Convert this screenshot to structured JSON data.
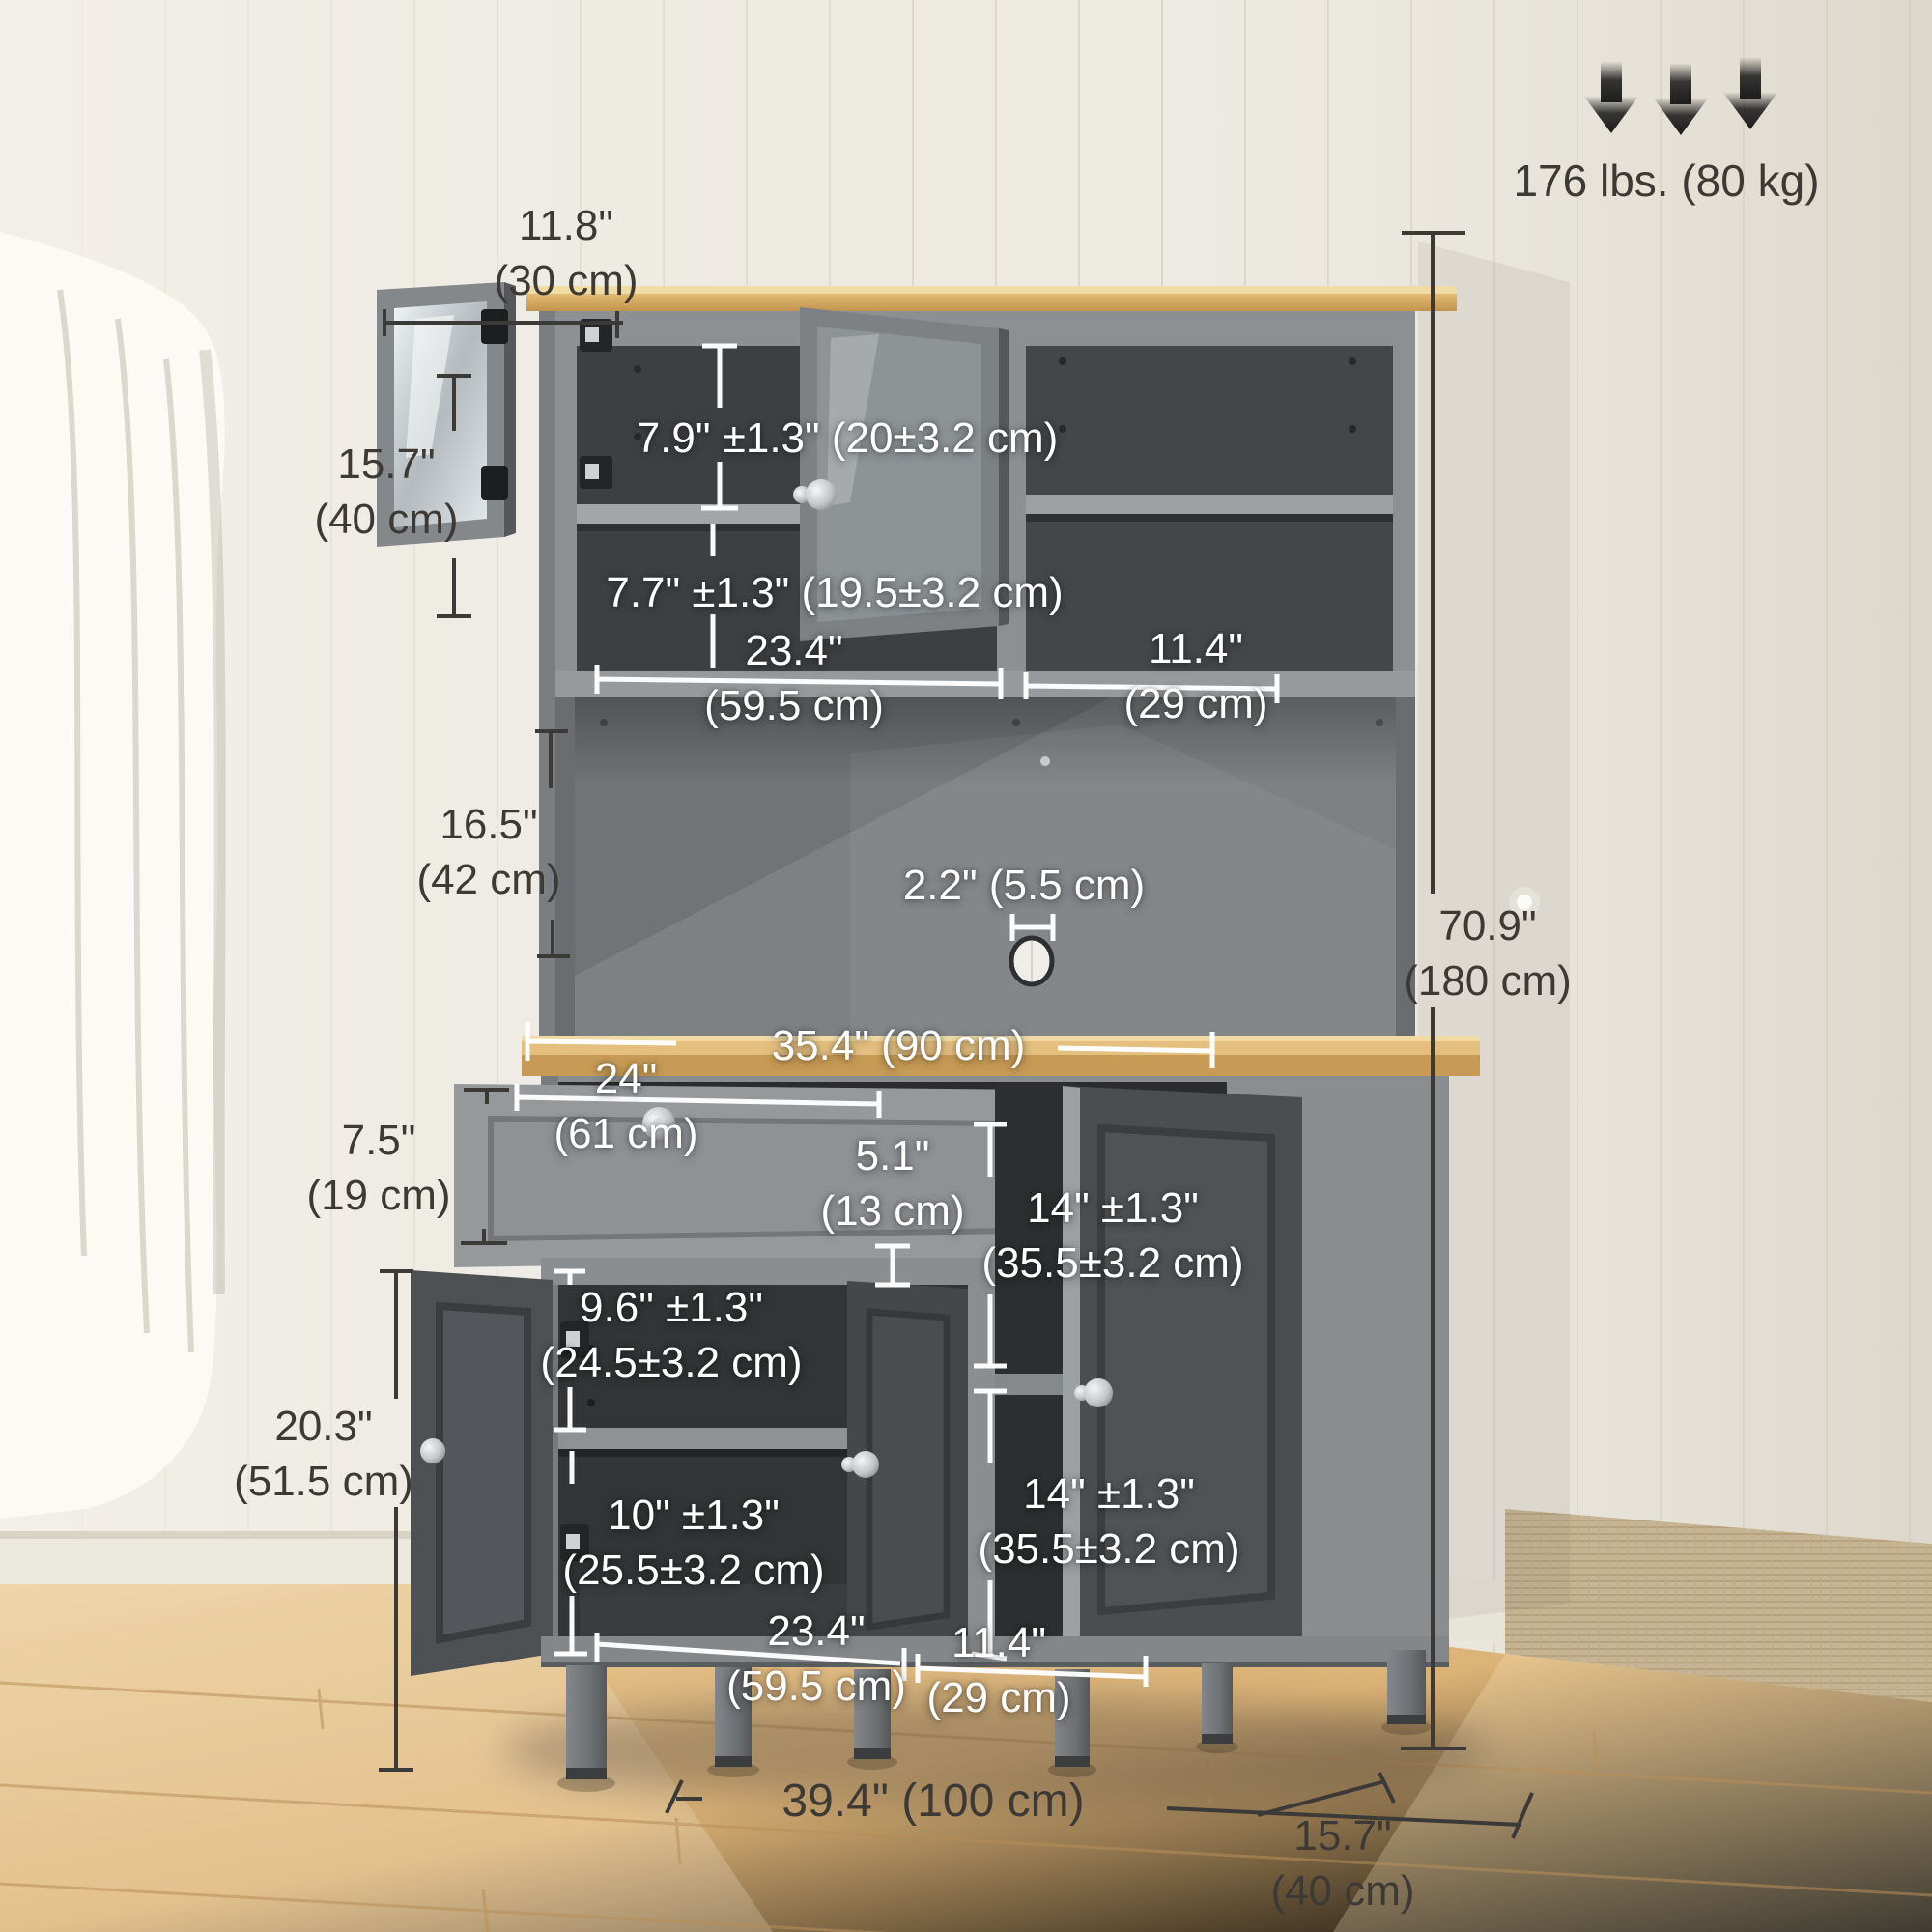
{
  "weight_capacity": {
    "label": "176 lbs. (80 kg)"
  },
  "dims": {
    "hutch_door_width": {
      "in": "11.8\"",
      "cm": "(30 cm)"
    },
    "hutch_door_height": {
      "in": "15.7\"",
      "cm": "(40 cm)"
    },
    "hutch_shelf_upper": {
      "label": "7.9\" ±1.3\" (20±3.2 cm)"
    },
    "hutch_shelf_lower": {
      "label": "7.7\" ±1.3\" (19.5±3.2 cm)"
    },
    "hutch_left_width": {
      "in": "23.4\"",
      "cm": "(59.5 cm)"
    },
    "hutch_right_width": {
      "in": "11.4\"",
      "cm": "(29 cm)"
    },
    "open_shelf_height": {
      "in": "16.5\"",
      "cm": "(42 cm)"
    },
    "cable_hole": {
      "label": "2.2\" (5.5 cm)"
    },
    "countertop_width": {
      "label": "35.4\" (90 cm)"
    },
    "overall_height": {
      "in": "70.9\"",
      "cm": "(180 cm)"
    },
    "drawer_width": {
      "in": "24\"",
      "cm": "(61 cm)"
    },
    "drawer_height": {
      "in": "7.5\"",
      "cm": "(19 cm)"
    },
    "drawer_depth": {
      "in": "5.1\"",
      "cm": "(13 cm)"
    },
    "right_upper_compartment": {
      "in": "14\" ±1.3\"",
      "cm": "(35.5±3.2 cm)"
    },
    "left_shelf_upper": {
      "in": "9.6\" ±1.3\"",
      "cm": "(24.5±3.2 cm)"
    },
    "base_cabinet_height": {
      "in": "20.3\"",
      "cm": "(51.5 cm)"
    },
    "left_shelf_lower": {
      "in": "10\" ±1.3\"",
      "cm": "(25.5±3.2 cm)"
    },
    "right_lower_compartment": {
      "in": "14\" ±1.3\"",
      "cm": "(35.5±3.2 cm)"
    },
    "base_left_width": {
      "in": "23.4\"",
      "cm": "(59.5 cm)"
    },
    "base_right_width": {
      "in": "11.4\"",
      "cm": "(29 cm)"
    },
    "overall_width": {
      "label": "39.4\" (100 cm)"
    },
    "overall_depth": {
      "in": "15.7\"",
      "cm": "(40 cm)"
    }
  },
  "colors": {
    "wall": "#edeae2",
    "floor_wood": "#d8ae72",
    "counter_wood": "#dfb873",
    "cabinet_gray": "#8d9093",
    "interior_gray": "#3d4043",
    "dimension_text_dark": "#3d3a35",
    "dimension_text_white": "#ffffff",
    "arrow_black": "#1f1f1e"
  }
}
